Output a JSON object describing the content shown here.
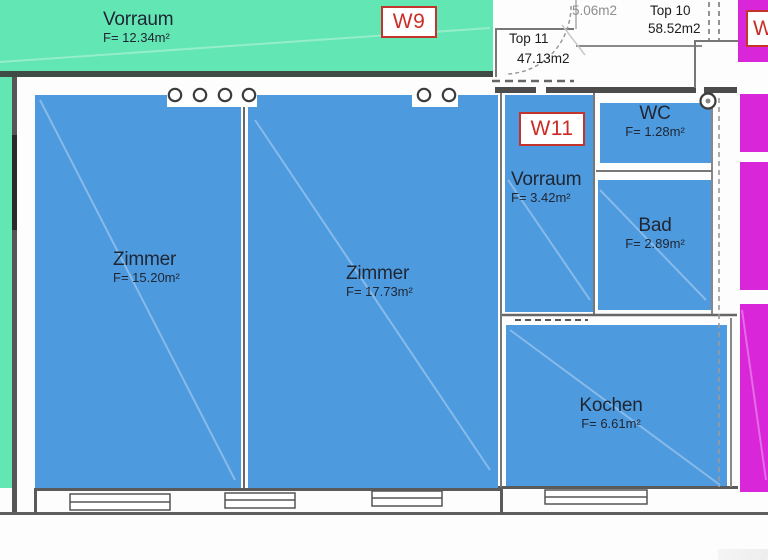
{
  "colors": {
    "unit_w9_overlay": "#62e6b3",
    "unit_w11_overlay": "#4e9adf",
    "adjacent_unit_overlay": "#d926d9",
    "badge_red": "#cb2d26",
    "room_label_text": "#1f2633",
    "annotation_text": "#1c1c1c",
    "faded_annotation_text": "#8e8e8e"
  },
  "badges": {
    "w9": "W9",
    "w11": "W11",
    "adjacent": "W"
  },
  "rooms": {
    "vorraum_w9": {
      "name": "Vorraum",
      "area": "F= 12.34m²"
    },
    "zimmer_1": {
      "name": "Zimmer",
      "area": "F= 15.20m²"
    },
    "zimmer_2": {
      "name": "Zimmer",
      "area": "F= 17.73m²"
    },
    "vorraum_w11": {
      "name": "Vorraum",
      "area": "F= 3.42m²"
    },
    "wc": {
      "name": "WC",
      "area": "F= 1.28m²"
    },
    "bad": {
      "name": "Bad",
      "area": "F= 2.89m²"
    },
    "kochen": {
      "name": "Kochen",
      "area": "F= 6.61m²"
    }
  },
  "top_annotations": {
    "top11_name": "Top 11",
    "top11_area": "47.13m2",
    "top10_name": "Top 10",
    "top10_area": "58.52m2",
    "small_room_area": "5.06m2"
  }
}
